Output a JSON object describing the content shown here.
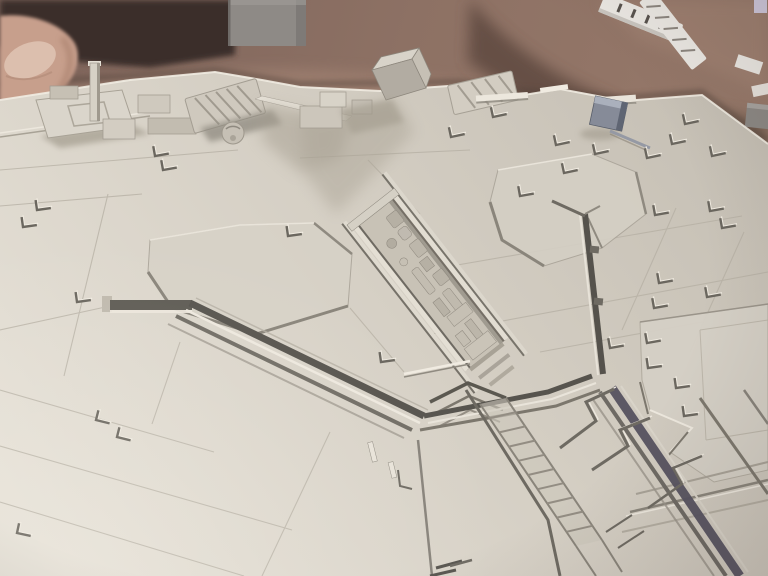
{
  "meta": {
    "description": "Photograph of a partially assembled light-gray Star Destroyer model kit hull, viewed at an oblique angle. The paneled plastic surface with raised greebles, trenches and a central detailed spine fills most of the frame. It rests on a wrinkled mauve-brown blanket; a fingertip intrudes at the top-left corner, a gray box sits at the top edge, and white sprue parts lie on the fabric at the top right."
  },
  "palette": {
    "fabric": "#87695c",
    "fabric_dark": "#5e4a41",
    "fabric_darker": "#3a2f2b",
    "fabric_light": "#a28373",
    "skin": "#c79f8c",
    "nail": "#dcbfae",
    "box_gray": "#8e8a86",
    "sprue_white": "#eae7e2",
    "hull_light": "#e4dfd5",
    "hull": "#d3cdc2",
    "hull_dark": "#c3bdb2",
    "hull_shadow": "#a29b8d",
    "trench_dark": "#57544e",
    "line_mid": "#7c776d",
    "line_soft": "#b5afa3",
    "edge_light": "#eee9df",
    "block_blue": "#868b98",
    "block_blue_dark": "#5f6573",
    "block_blue_light": "#aab0bc"
  },
  "scene": {
    "objects": [
      "blanket-background",
      "fingertip",
      "gray-box",
      "sprue-parts",
      "star-destroyer-hull",
      "superstructure-blocks",
      "tilted-box-part",
      "blue-block-part",
      "center-greeble-trench",
      "v-trenches",
      "hex-panels",
      "stern-trench-bands",
      "ladder-detail",
      "l-greebles"
    ],
    "l_greebles": [
      [
        37,
        210,
        -8
      ],
      [
        23,
        227,
        -8
      ],
      [
        77,
        302,
        -8
      ],
      [
        155,
        156,
        -10
      ],
      [
        163,
        170,
        -10
      ],
      [
        288,
        236,
        -8
      ],
      [
        381,
        362,
        -8
      ],
      [
        96,
        420,
        14
      ],
      [
        117,
        437,
        14
      ],
      [
        17,
        533,
        12
      ],
      [
        451,
        137,
        -12
      ],
      [
        493,
        117,
        -12
      ],
      [
        556,
        145,
        -12
      ],
      [
        564,
        173,
        -12
      ],
      [
        595,
        154,
        -12
      ],
      [
        647,
        158,
        -12
      ],
      [
        685,
        124,
        -12
      ],
      [
        672,
        144,
        -12
      ],
      [
        712,
        156,
        -12
      ],
      [
        520,
        196,
        -10
      ],
      [
        655,
        215,
        -10
      ],
      [
        710,
        211,
        -10
      ],
      [
        722,
        228,
        -10
      ],
      [
        659,
        283,
        -10
      ],
      [
        707,
        297,
        -10
      ],
      [
        654,
        308,
        -10
      ],
      [
        610,
        348,
        -10
      ],
      [
        647,
        343,
        -10
      ],
      [
        676,
        388,
        -8
      ],
      [
        684,
        416,
        -8
      ],
      [
        648,
        368,
        -8
      ]
    ],
    "ladder": {
      "x1": 480,
      "y1": 404,
      "x2": 576,
      "y2": 546,
      "dx": 26,
      "dy": -6,
      "rungs": 10
    }
  }
}
